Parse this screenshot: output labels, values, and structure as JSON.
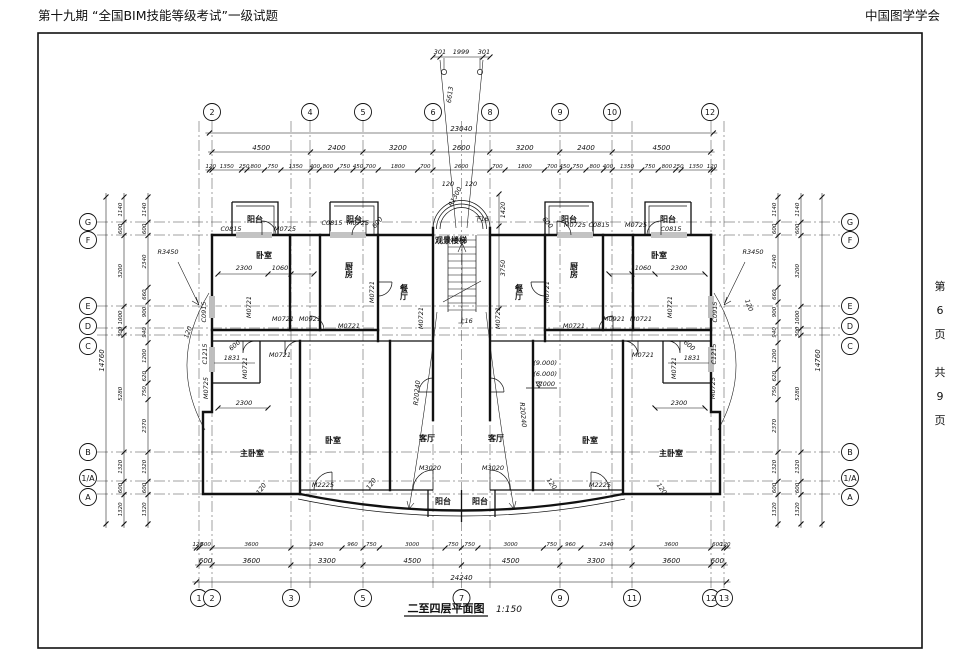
{
  "header": {
    "title": "第十九期 “全国BIM技能等级考试”一级试题",
    "org": "中国图学学会"
  },
  "page_info": {
    "chars": [
      "第",
      "6",
      "页",
      "共",
      "9",
      "页"
    ]
  },
  "caption": {
    "title": "二至四层平面图",
    "scale": "1:150"
  },
  "grid": {
    "top": [
      "2",
      "4",
      "5",
      "6",
      "8",
      "9",
      "10",
      "12"
    ],
    "bottom": [
      "1",
      "2",
      "3",
      "5",
      "7",
      "9",
      "11",
      "12",
      "13"
    ],
    "left": [
      "G",
      "F",
      "E",
      "D",
      "C",
      "B",
      "1/A",
      "A"
    ],
    "right": [
      "G",
      "F",
      "E",
      "D",
      "C",
      "B",
      "1/A",
      "A"
    ]
  },
  "dims": {
    "top_total": [
      "23040"
    ],
    "top_main": [
      "4500",
      "2400",
      "3200",
      "2600",
      "3200",
      "2400",
      "4500"
    ],
    "top_detail": [
      "120",
      "1350",
      "250",
      "800",
      "750",
      "1350",
      "400",
      "800",
      "750",
      "450",
      "700",
      "1800",
      "700",
      "2600",
      "700",
      "1800",
      "700",
      "450",
      "750",
      "800",
      "400",
      "1350",
      "750",
      "800",
      "250",
      "1350",
      "120"
    ],
    "bottom_total": [
      "24240"
    ],
    "bottom_main": [
      "600",
      "3600",
      "3300",
      "4500",
      "4500",
      "3300",
      "3600",
      "600"
    ],
    "bottom_detail": [
      "120",
      "600",
      "3600",
      "2340",
      "960",
      "750",
      "3000",
      "750",
      "750",
      "3000",
      "750",
      "960",
      "2340",
      "3600",
      "600",
      "120"
    ],
    "left_total": [
      "14760"
    ],
    "left_main": [
      "1140",
      "600",
      "3200",
      "1000",
      "300",
      "5280",
      "1320",
      "600",
      "1320"
    ],
    "left_detail": [
      "1140",
      "600",
      "2340",
      "660",
      "900",
      "940",
      "1200",
      "620",
      "750",
      "2370",
      "1320",
      "600",
      "1320"
    ],
    "right_total": [
      "14760"
    ],
    "right_main": [
      "1140",
      "600",
      "3200",
      "1000",
      "300",
      "5280",
      "1320",
      "600",
      "1320"
    ],
    "right_detail": [
      "1140",
      "600",
      "2340",
      "660",
      "900",
      "940",
      "1200",
      "620",
      "750",
      "2370",
      "1320",
      "600",
      "1320"
    ]
  },
  "plan": {
    "rooms_left": [
      "阳台",
      "阳台",
      "卧室",
      "厨房",
      "餐厅",
      "主卧室",
      "卧室",
      "客厅",
      "阳台"
    ],
    "rooms_right": [
      "阳台",
      "阳台",
      "卧室",
      "厨房",
      "餐厅",
      "主卧室",
      "卧室",
      "客厅",
      "阳台"
    ],
    "stair": {
      "name": "观景楼梯",
      "down": "下16",
      "up": "上16",
      "radius": "R1300"
    },
    "tags_top_left": [
      "C0815",
      "M0725",
      "C0815",
      "M0725"
    ],
    "tags_top_right": [
      "M0725",
      "C0815",
      "M0725",
      "C0815"
    ],
    "tags_left": [
      "M0721",
      "M0721",
      "M0721",
      "M0921",
      "M0721",
      "M0721",
      "M0721",
      "M0721",
      "C0915",
      "C1215",
      "M0725",
      "M2225",
      "M3020"
    ],
    "tags_right": [
      "M0721",
      "M0721",
      "M0921",
      "M0721",
      "M0721",
      "M0721",
      "M0721",
      "M0721",
      "C0915",
      "C1215",
      "M0725",
      "M2225",
      "M3020"
    ],
    "dims_left": [
      "2300",
      "1060",
      "600",
      "1831",
      "2300"
    ],
    "dims_right": [
      "1060",
      "2300",
      "600",
      "1831",
      "2300"
    ],
    "radii": [
      "R3450",
      "R20240",
      "R20240",
      "R3450"
    ],
    "levels": [
      "(9.000)",
      "(6.000)",
      "3.000"
    ],
    "stair_dims": [
      "120",
      "120",
      "1420",
      "3750",
      "600",
      "600"
    ],
    "entry_dims": [
      "301",
      "1999",
      "301",
      "6613"
    ],
    "small_dims": [
      "120",
      "120",
      "120",
      "120",
      "120",
      "120"
    ]
  }
}
